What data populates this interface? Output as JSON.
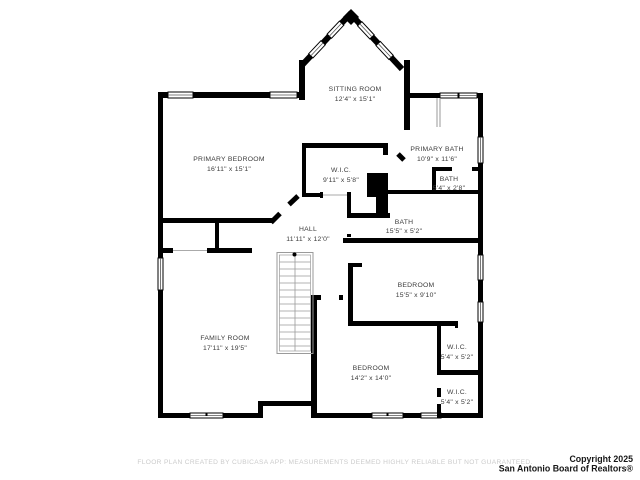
{
  "plan": {
    "rooms": [
      {
        "id": "sitting-room",
        "name": "SITTING ROOM",
        "dims": "12'4\" x 15'1\""
      },
      {
        "id": "primary-bedroom",
        "name": "PRIMARY BEDROOM",
        "dims": "16'11\" x 15'1\""
      },
      {
        "id": "primary-bath",
        "name": "PRIMARY BATH",
        "dims": "10'9\" x 11'6\""
      },
      {
        "id": "bath-small",
        "name": "BATH",
        "dims": "5'4\" x 2'8\""
      },
      {
        "id": "wic-hall",
        "name": "W.I.C.",
        "dims": "9'11\" x 5'8\""
      },
      {
        "id": "hall",
        "name": "HALL",
        "dims": "11'11\" x 12'0\""
      },
      {
        "id": "bath",
        "name": "BATH",
        "dims": "15'5\" x 5'2\""
      },
      {
        "id": "bedroom-east",
        "name": "BEDROOM",
        "dims": "15'5\" x 9'10\""
      },
      {
        "id": "family-room",
        "name": "FAMILY ROOM",
        "dims": "17'11\" x 19'5\""
      },
      {
        "id": "bedroom-south",
        "name": "BEDROOM",
        "dims": "14'2\" x 14'0\""
      },
      {
        "id": "wic-upper",
        "name": "W.I.C.",
        "dims": "5'4\" x 5'2\""
      },
      {
        "id": "wic-lower",
        "name": "W.I.C.",
        "dims": "5'4\" x 5'2\""
      }
    ],
    "colors": {
      "wall": "#000000",
      "room_label": "#3c3c3c",
      "stairs": "#9a9a9a",
      "disclaimer": "#cbcbcb",
      "copyright": "#161616",
      "background": "#ffffff"
    }
  },
  "footer": {
    "disclaimer": "FLOOR PLAN CREATED BY CUBICASA APP: MEASUREMENTS DEEMED HIGHLY RELIABLE BUT NOT GUARANTEED.",
    "copyright_line1": "Copyright 2025",
    "copyright_line2": "San Antonio Board of Realtors®"
  }
}
